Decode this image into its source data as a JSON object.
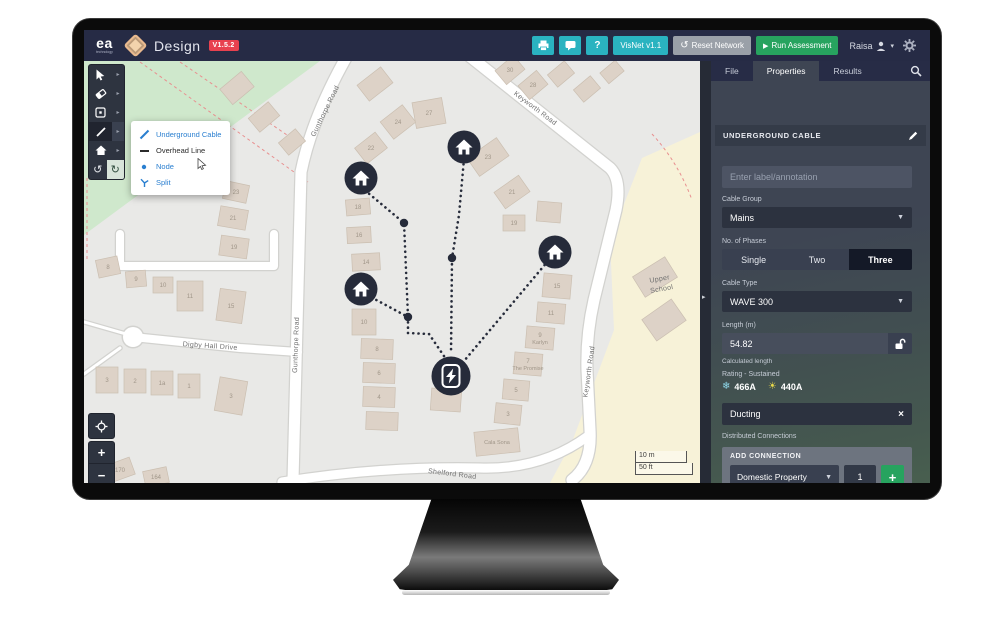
{
  "topbar": {
    "brand": "ea",
    "brand_sub": "technology",
    "product": "Design",
    "version": "V1.5.2",
    "visnet_label": "VisNet v1.1",
    "reset_label": "Reset Network",
    "run_label": "Run Assessment",
    "user": "Raisa"
  },
  "panel": {
    "tabs": [
      "File",
      "Properties",
      "Results"
    ],
    "active_tab": "Properties",
    "section_title": "UNDERGROUND CABLE",
    "label_placeholder": "Enter label/annotation",
    "cable_group_label": "Cable Group",
    "cable_group_value": "Mains",
    "phases_label": "No. of Phases",
    "phases_options": [
      "Single",
      "Two",
      "Three"
    ],
    "phases_selected": "Three",
    "cable_type_label": "Cable Type",
    "cable_type_value": "WAVE 300",
    "length_label": "Length (m)",
    "length_value": "54.82",
    "length_note": "Calculated length",
    "rating_label": "Rating - Sustained",
    "rating_cold_icon": "❄",
    "rating_cold": "466A",
    "rating_warm_icon": "☀",
    "rating_warm": "440A",
    "ducting_value": "Ducting",
    "distributed_label": "Distributed Connections",
    "add_connection_title": "ADD CONNECTION",
    "connection_type_value": "Domestic Property",
    "connection_qty": "1"
  },
  "context_menu": {
    "items": [
      {
        "label": "Underground Cable",
        "tone": "blue",
        "icon": "diagonal-line"
      },
      {
        "label": "Overhead Line",
        "tone": "dark",
        "icon": "horizontal-line"
      },
      {
        "label": "Node",
        "tone": "blue",
        "icon": "dot"
      },
      {
        "label": "Split",
        "tone": "blue",
        "icon": "split"
      }
    ]
  },
  "map": {
    "scale_metric": "10 m",
    "scale_imperial": "50 ft",
    "zones": [
      {
        "d": "M84,61 L320,61 L84,235 Z",
        "f": "#cfe8cc"
      },
      {
        "d": "M700,132 L642,158 L610,240 L614,330 L572,442 L550,483 L700,483 Z",
        "f": "#f7f2d8"
      }
    ],
    "boundary_dashes": [
      "M140,62 L308,182",
      "M180,62 L312,152",
      "M87,178 L87,262",
      "M652,134 Q678,162 692,200"
    ],
    "roads": [
      {
        "d": "M347,56 Q312,118 301,172 L293,480",
        "w": 11
      },
      {
        "d": "M468,55 L610,168 Q622,180 616,210 L594,300 Q586,335 587,370 L590,430 Q592,465 572,480",
        "w": 11
      },
      {
        "d": "M133,337 L240,348 L298,352",
        "w": 8
      },
      {
        "d": "M282,482 Q380,466 480,468 Q542,470 588,436",
        "w": 9
      },
      {
        "d": "M120,234 L120,266 L274,266 L274,234",
        "w": 8
      },
      {
        "d": "M84,322 L133,336",
        "w": 3
      },
      {
        "d": "M84,374 L120,348",
        "w": 3
      }
    ],
    "roundabout": {
      "x": 133,
      "y": 337,
      "r": 10
    },
    "road_labels": [
      {
        "t": "Gunthorpe Road",
        "x": 327,
        "y": 112,
        "r": -64
      },
      {
        "t": "Gunthorpe Road",
        "x": 298,
        "y": 345,
        "r": -88
      },
      {
        "t": "Keyworth Road",
        "x": 534,
        "y": 110,
        "r": 37
      },
      {
        "t": "Keyworth Road",
        "x": 591,
        "y": 372,
        "r": -82
      },
      {
        "t": "Digby Hall Drive",
        "x": 210,
        "y": 348,
        "r": 4
      },
      {
        "t": "Shelford Road",
        "x": 452,
        "y": 476,
        "r": 7
      },
      {
        "t": "Upper",
        "x": 660,
        "y": 281,
        "r": -10
      },
      {
        "t": "School",
        "x": 662,
        "y": 291,
        "r": -10
      }
    ],
    "buildings": [
      {
        "x": 237,
        "y": 88,
        "w": 28,
        "h": 20,
        "r": -40,
        "n": ""
      },
      {
        "x": 264,
        "y": 117,
        "w": 26,
        "h": 18,
        "r": -40,
        "n": ""
      },
      {
        "x": 292,
        "y": 142,
        "w": 22,
        "h": 16,
        "r": -40,
        "n": ""
      },
      {
        "x": 375,
        "y": 84,
        "w": 30,
        "h": 20,
        "r": -38,
        "n": ""
      },
      {
        "x": 398,
        "y": 122,
        "w": 28,
        "h": 22,
        "r": -38,
        "n": "24"
      },
      {
        "x": 429,
        "y": 113,
        "w": 30,
        "h": 26,
        "r": -10,
        "n": "27"
      },
      {
        "x": 371,
        "y": 148,
        "w": 26,
        "h": 20,
        "r": -38,
        "n": "22"
      },
      {
        "x": 488,
        "y": 157,
        "w": 36,
        "h": 22,
        "r": -35,
        "n": "23"
      },
      {
        "x": 512,
        "y": 192,
        "w": 30,
        "h": 20,
        "r": -35,
        "n": "21"
      },
      {
        "x": 510,
        "y": 70,
        "w": 24,
        "h": 18,
        "r": -40,
        "n": "30"
      },
      {
        "x": 533,
        "y": 85,
        "w": 24,
        "h": 18,
        "r": -40,
        "n": "28"
      },
      {
        "x": 561,
        "y": 74,
        "w": 22,
        "h": 16,
        "r": -40,
        "n": ""
      },
      {
        "x": 587,
        "y": 89,
        "w": 22,
        "h": 16,
        "r": -40,
        "n": ""
      },
      {
        "x": 612,
        "y": 72,
        "w": 20,
        "h": 14,
        "r": -40,
        "n": ""
      },
      {
        "x": 358,
        "y": 207,
        "w": 24,
        "h": 16,
        "r": -5,
        "n": "18"
      },
      {
        "x": 359,
        "y": 235,
        "w": 24,
        "h": 16,
        "r": -3,
        "n": "16"
      },
      {
        "x": 366,
        "y": 262,
        "w": 28,
        "h": 17,
        "r": -3,
        "n": "14"
      },
      {
        "x": 364,
        "y": 322,
        "w": 24,
        "h": 26,
        "r": 0,
        "n": "10"
      },
      {
        "x": 377,
        "y": 349,
        "w": 32,
        "h": 20,
        "r": 2,
        "n": "8"
      },
      {
        "x": 379,
        "y": 373,
        "w": 32,
        "h": 20,
        "r": 2,
        "n": "6"
      },
      {
        "x": 379,
        "y": 397,
        "w": 32,
        "h": 20,
        "r": 2,
        "n": "4"
      },
      {
        "x": 382,
        "y": 421,
        "w": 32,
        "h": 18,
        "r": 2,
        "n": ""
      },
      {
        "x": 514,
        "y": 223,
        "w": 22,
        "h": 16,
        "r": 0,
        "n": "19"
      },
      {
        "x": 549,
        "y": 212,
        "w": 24,
        "h": 20,
        "r": 5,
        "n": ""
      },
      {
        "x": 557,
        "y": 286,
        "w": 28,
        "h": 24,
        "r": 5,
        "n": "15"
      },
      {
        "x": 551,
        "y": 313,
        "w": 28,
        "h": 20,
        "r": 5,
        "n": "11"
      },
      {
        "x": 540,
        "y": 338,
        "w": 28,
        "h": 22,
        "r": 5,
        "n": "9",
        "s": "Karlyn"
      },
      {
        "x": 528,
        "y": 364,
        "w": 28,
        "h": 22,
        "r": 5,
        "n": "7",
        "s": "The Promise"
      },
      {
        "x": 516,
        "y": 390,
        "w": 26,
        "h": 20,
        "r": 5,
        "n": "5"
      },
      {
        "x": 508,
        "y": 414,
        "w": 26,
        "h": 20,
        "r": 6,
        "n": "3"
      },
      {
        "x": 497,
        "y": 442,
        "w": 44,
        "h": 24,
        "r": -6,
        "n": "",
        "s": "Cala Sona"
      },
      {
        "x": 446,
        "y": 400,
        "w": 30,
        "h": 22,
        "r": 4,
        "n": ""
      },
      {
        "x": 236,
        "y": 192,
        "w": 24,
        "h": 18,
        "r": 12,
        "n": "23"
      },
      {
        "x": 233,
        "y": 218,
        "w": 28,
        "h": 20,
        "r": 10,
        "n": "21"
      },
      {
        "x": 234,
        "y": 247,
        "w": 28,
        "h": 20,
        "r": 8,
        "n": "19"
      },
      {
        "x": 108,
        "y": 267,
        "w": 22,
        "h": 18,
        "r": -12,
        "n": "8"
      },
      {
        "x": 136,
        "y": 279,
        "w": 20,
        "h": 16,
        "r": -5,
        "n": "9"
      },
      {
        "x": 163,
        "y": 285,
        "w": 20,
        "h": 16,
        "r": 0,
        "n": "10"
      },
      {
        "x": 190,
        "y": 296,
        "w": 26,
        "h": 30,
        "r": 0,
        "n": "11"
      },
      {
        "x": 231,
        "y": 306,
        "w": 26,
        "h": 32,
        "r": 8,
        "n": "15"
      },
      {
        "x": 107,
        "y": 380,
        "w": 22,
        "h": 26,
        "r": 0,
        "n": "3"
      },
      {
        "x": 135,
        "y": 381,
        "w": 22,
        "h": 24,
        "r": 0,
        "n": "2"
      },
      {
        "x": 162,
        "y": 383,
        "w": 22,
        "h": 24,
        "r": 0,
        "n": "1a"
      },
      {
        "x": 189,
        "y": 386,
        "w": 22,
        "h": 24,
        "r": 0,
        "n": "1"
      },
      {
        "x": 231,
        "y": 396,
        "w": 28,
        "h": 34,
        "r": 10,
        "n": "3"
      },
      {
        "x": 120,
        "y": 470,
        "w": 26,
        "h": 18,
        "r": -20,
        "n": "170"
      },
      {
        "x": 156,
        "y": 477,
        "w": 24,
        "h": 16,
        "r": -12,
        "n": "164"
      },
      {
        "x": 655,
        "y": 277,
        "w": 38,
        "h": 24,
        "r": -32,
        "n": ""
      },
      {
        "x": 664,
        "y": 320,
        "w": 36,
        "h": 26,
        "r": -35,
        "n": ""
      }
    ],
    "network": {
      "cables": [
        "M361,187 L404,223 L408,317",
        "M367,295 L408,317",
        "M408,317 L408,333 L429,334 L448,362",
        "M464,159 L459,215 L452,258 L451,354",
        "M548,261 L459,367"
      ],
      "junctions": [
        [
          404,
          223
        ],
        [
          452,
          258
        ],
        [
          408,
          317
        ]
      ],
      "houses": [
        [
          361,
          178
        ],
        [
          464,
          147
        ],
        [
          555,
          252
        ],
        [
          361,
          289
        ]
      ],
      "transformer": [
        451,
        376
      ]
    }
  },
  "colors": {
    "accent_teal": "#2ab3c0",
    "action_green": "#27a35f",
    "version_red": "#e8414f",
    "navy": "#262b45",
    "node_dark": "#262b3a",
    "menu_blue": "#2a7fd0",
    "building_fill": "#ddd2c7",
    "building_stroke": "#cbbfb1",
    "zone_green": "#cfe8cc",
    "zone_yellow": "#f7f2d8"
  }
}
